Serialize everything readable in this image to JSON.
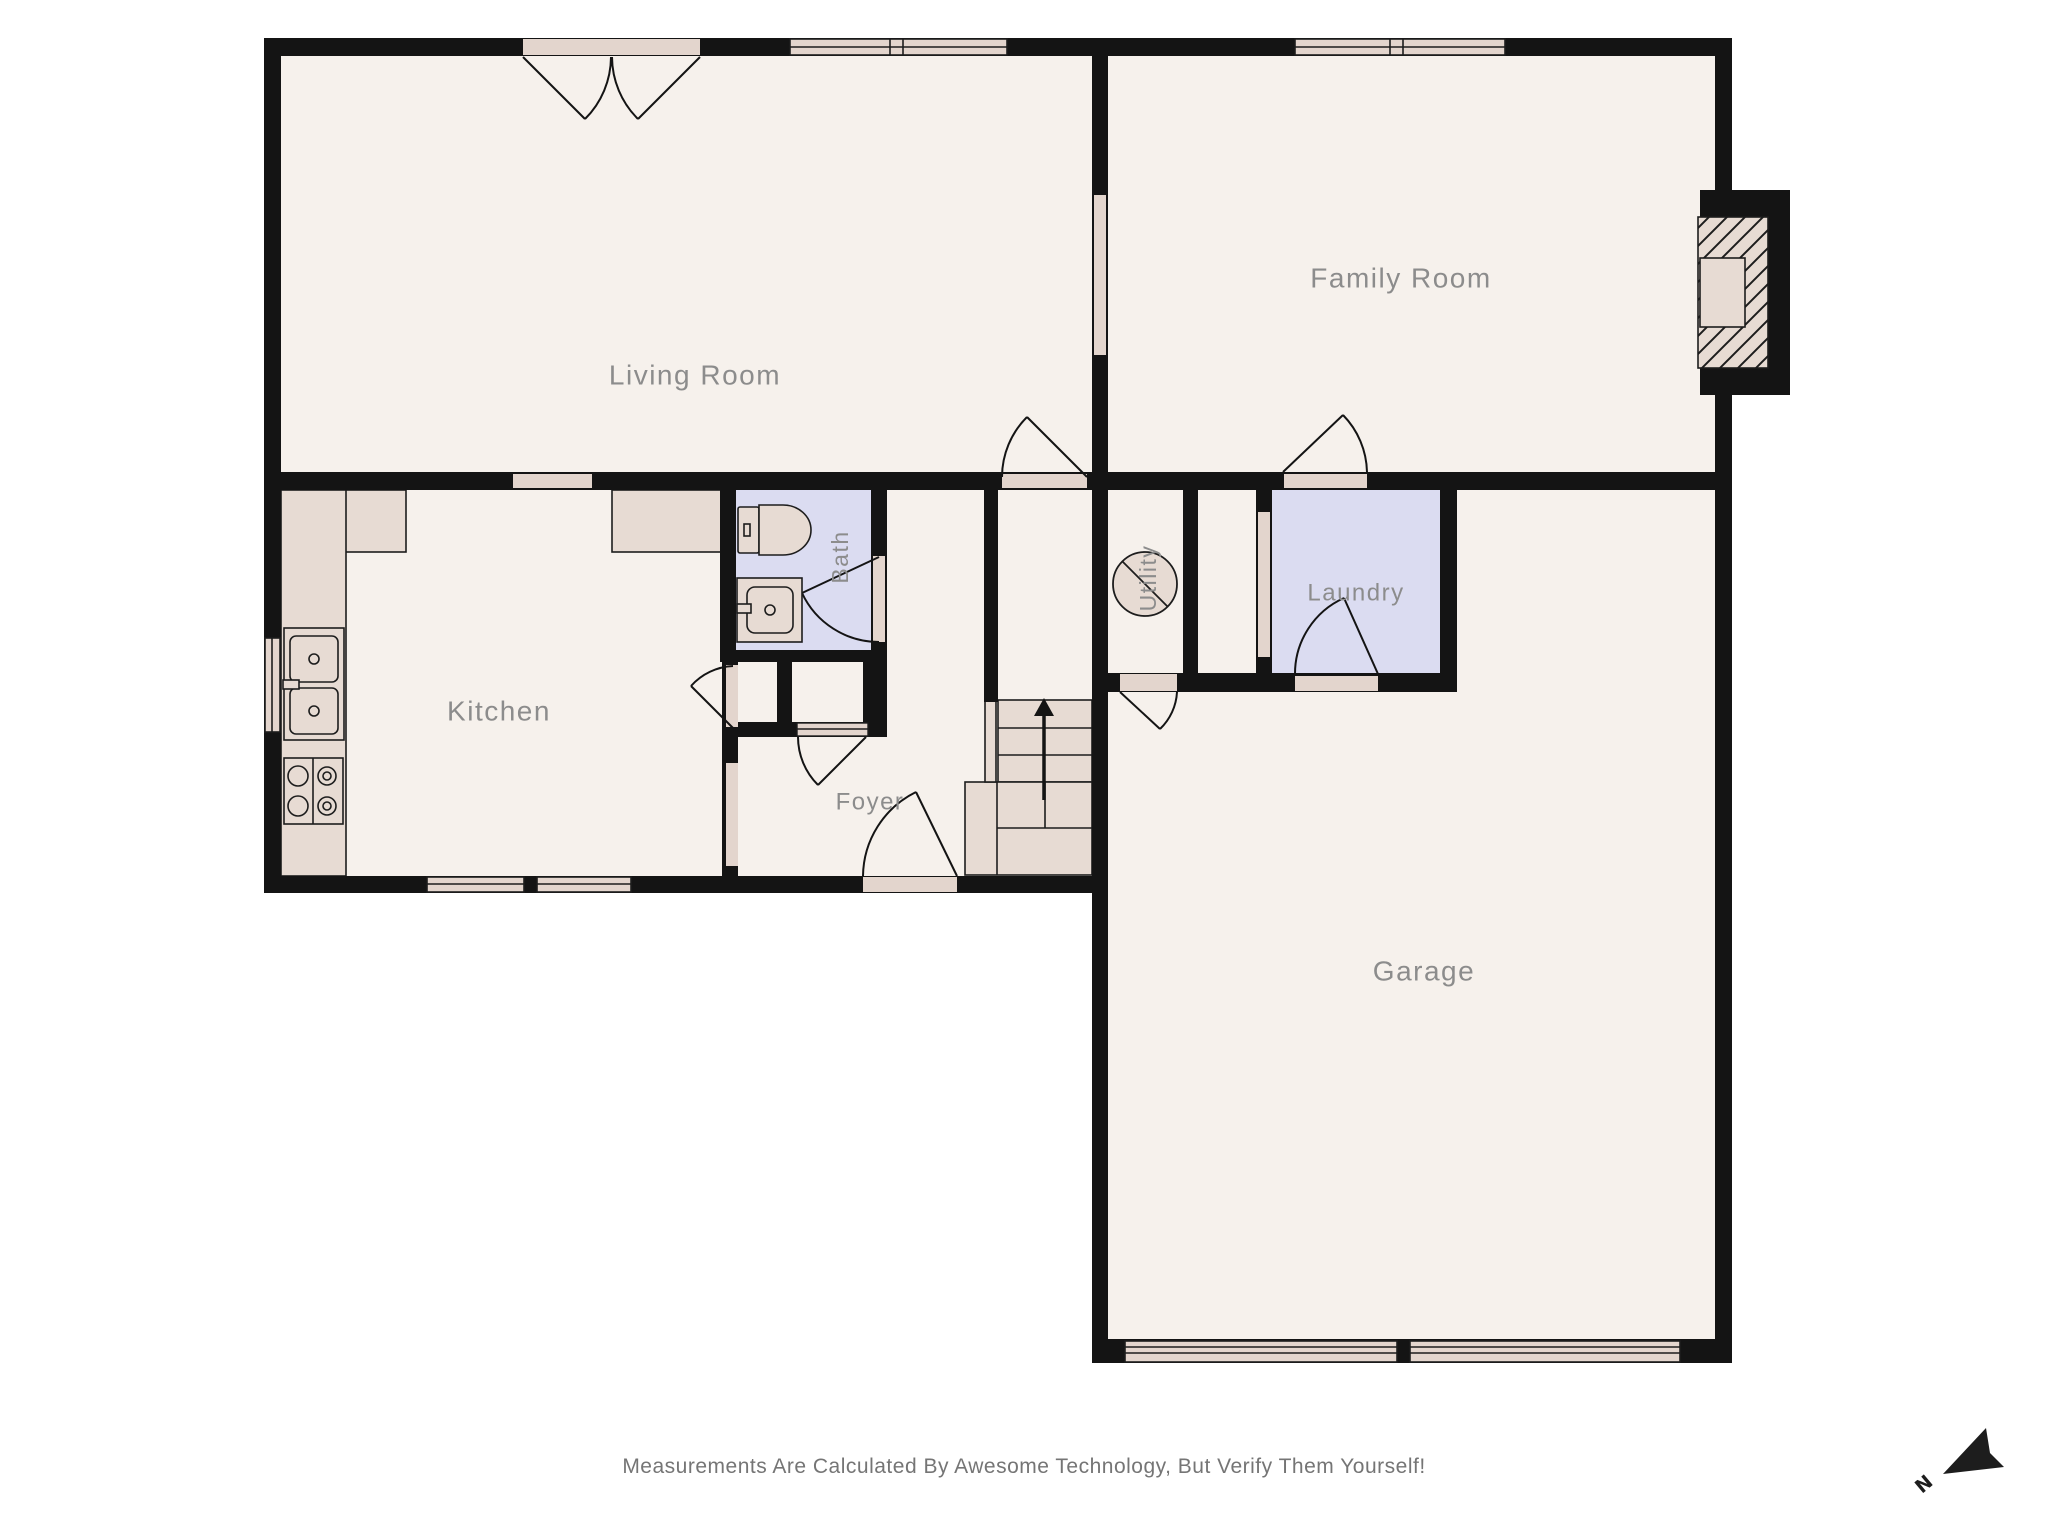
{
  "title": "First Floor Plan",
  "rooms": {
    "living": {
      "label": "Living Room"
    },
    "family": {
      "label": "Family Room"
    },
    "kitchen": {
      "label": "Kitchen"
    },
    "bath": {
      "label": "Bath"
    },
    "foyer": {
      "label": "Foyer"
    },
    "utility": {
      "label": "Utility"
    },
    "laundry": {
      "label": "Laundry"
    },
    "garage": {
      "label": "Garage"
    }
  },
  "compass": {
    "label": "N"
  },
  "footer": {
    "disclaimer": "Measurements Are Calculated By Awesome Technology, But Verify Them Yourself!"
  },
  "colors": {
    "wall": "#141414",
    "floor": "#f6f1ec",
    "wet_floor": "#dbdcf1",
    "fixture": "#e7dbd3",
    "opening": "#e3d5cd",
    "label": "#8c8c8c",
    "footer_text": "#757575"
  }
}
